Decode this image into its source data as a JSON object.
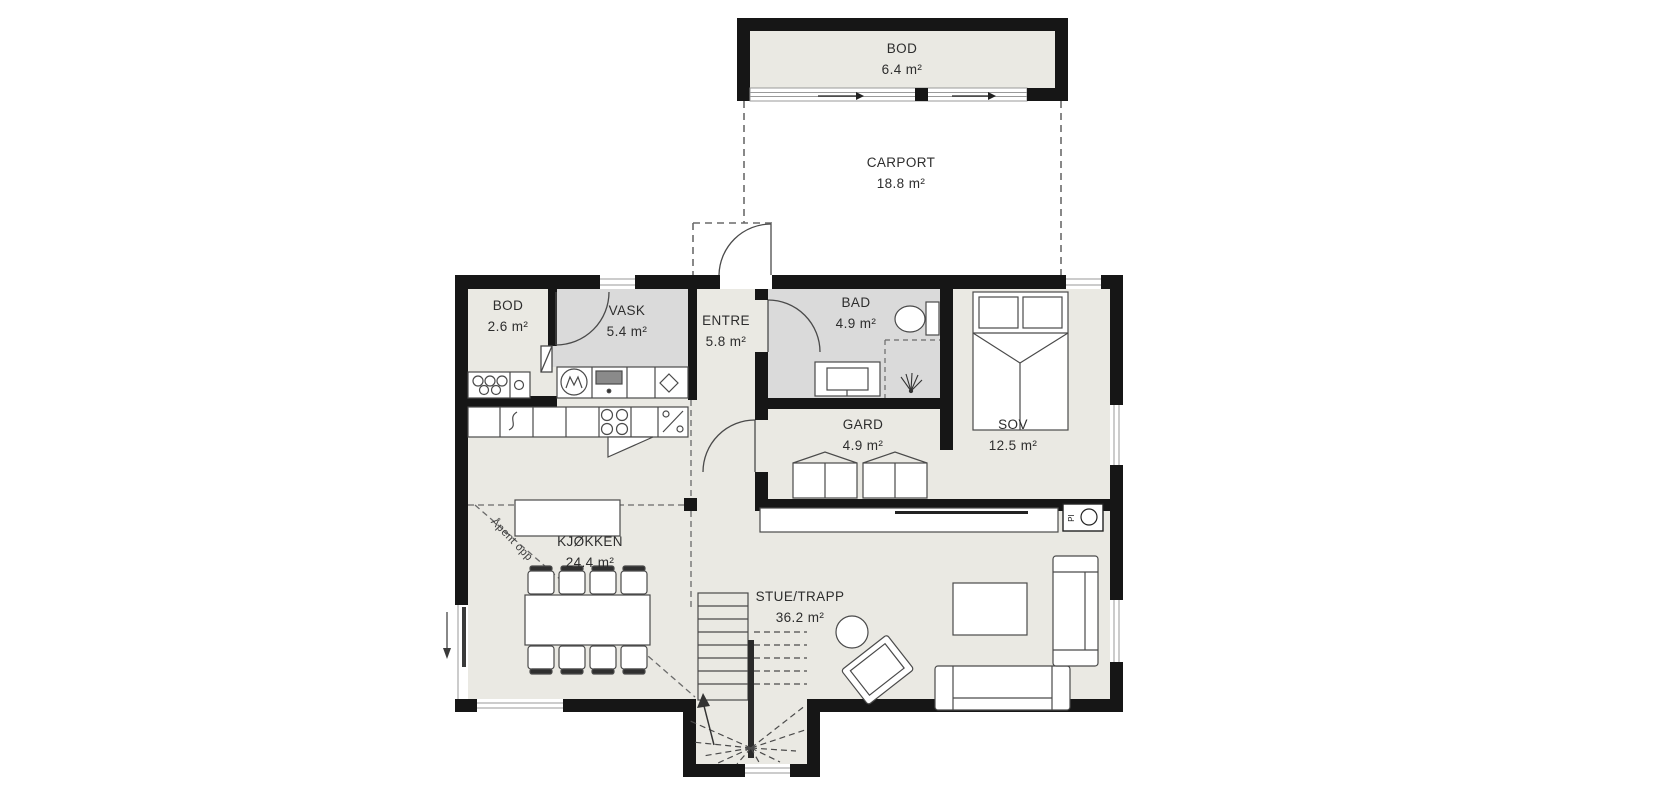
{
  "document": {
    "type": "floor-plan"
  },
  "labels": {
    "bod_top": {
      "name": "BOD",
      "area": "6.4 m²"
    },
    "carport": {
      "name": "CARPORT",
      "area": "18.8 m²"
    },
    "bod": {
      "name": "BOD",
      "area": "2.6 m²"
    },
    "vask": {
      "name": "VASK",
      "area": "5.4 m²"
    },
    "entre": {
      "name": "ENTRE",
      "area": "5.8 m²"
    },
    "bad": {
      "name": "BAD",
      "area": "4.9 m²"
    },
    "gard": {
      "name": "GARD",
      "area": "4.9 m²"
    },
    "sov": {
      "name": "SOV",
      "area": "12.5 m²"
    },
    "kjokken": {
      "name": "KJØKKEN",
      "area": "24.4 m²"
    },
    "stue": {
      "name": "STUE/TRAPP",
      "area": "36.2 m²"
    }
  },
  "annotations": {
    "open_above": "Åpent opp",
    "fireplace_label": "PI"
  },
  "colors": {
    "wall": "#161616",
    "floor": "#eae9e3",
    "wet_room": "#dadada",
    "furniture_line": "#4a4a4a",
    "window_line": "#9a9a9a",
    "dash_line": "#6a6a6a"
  }
}
